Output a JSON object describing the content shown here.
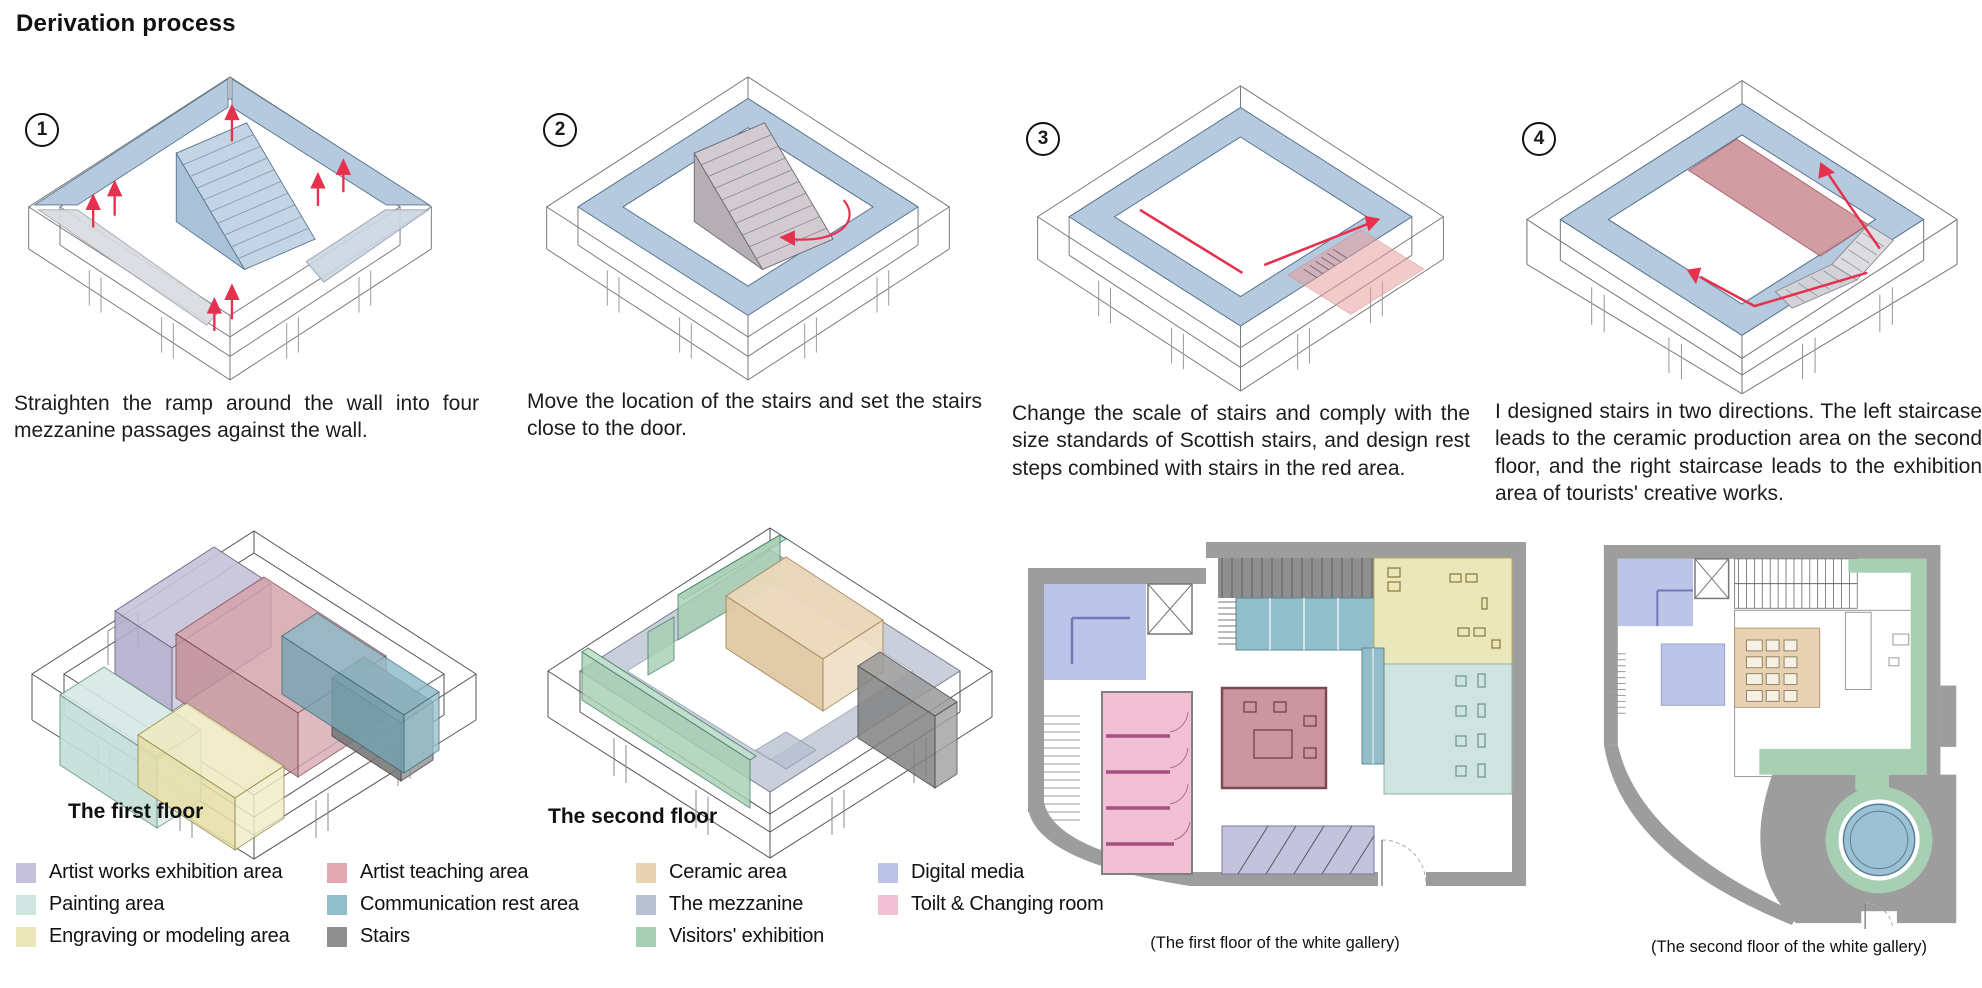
{
  "title": "Derivation process",
  "steps": [
    {
      "number": "1",
      "caption": "Straighten the ramp around the wall into four mezzanine passages against the wall."
    },
    {
      "number": "2",
      "caption": "Move the location of the stairs and set the stairs close to the door."
    },
    {
      "number": "3",
      "caption": "Change the scale of stairs and comply with the size standards of Scottish stairs, and design rest steps combined with stairs in the red area."
    },
    {
      "number": "4",
      "caption": "I designed stairs in two directions. The left staircase leads to the ceramic production area on the second floor, and the right staircase leads to the exhibition area of tourists' creative works."
    }
  ],
  "axonometrics": [
    {
      "label": "The first floor"
    },
    {
      "label": "The second floor"
    }
  ],
  "floor_plans": [
    {
      "caption": "(The first floor of the white gallery)"
    },
    {
      "caption": "(The second floor of the white gallery)"
    }
  ],
  "legend": {
    "items": [
      {
        "label": "Artist works exhibition area",
        "color": "#c6c2d9"
      },
      {
        "label": "Painting area",
        "color": "#cfe3df"
      },
      {
        "label": "Engraving or modeling area",
        "color": "#ece7ba"
      },
      {
        "label": "Artist teaching area",
        "color": "#e2a9b1"
      },
      {
        "label": "Communication rest area",
        "color": "#92bec9"
      },
      {
        "label": "Stairs",
        "color": "#8f8f8f"
      },
      {
        "label": "Ceramic area",
        "color": "#e7d2b3"
      },
      {
        "label": "The mezzanine",
        "color": "#b7c1d1"
      },
      {
        "label": "Visitors' exhibition",
        "color": "#a7cfb3"
      },
      {
        "label": "Digital media",
        "color": "#bcc5e7"
      },
      {
        "label": "Toilt & Changing room",
        "color": "#f2c0d4"
      }
    ]
  },
  "colors": {
    "mezzanine_blue": "#b5cade",
    "route_red": "#e6314e",
    "plan_wall_gray": "#9d9d9d"
  }
}
